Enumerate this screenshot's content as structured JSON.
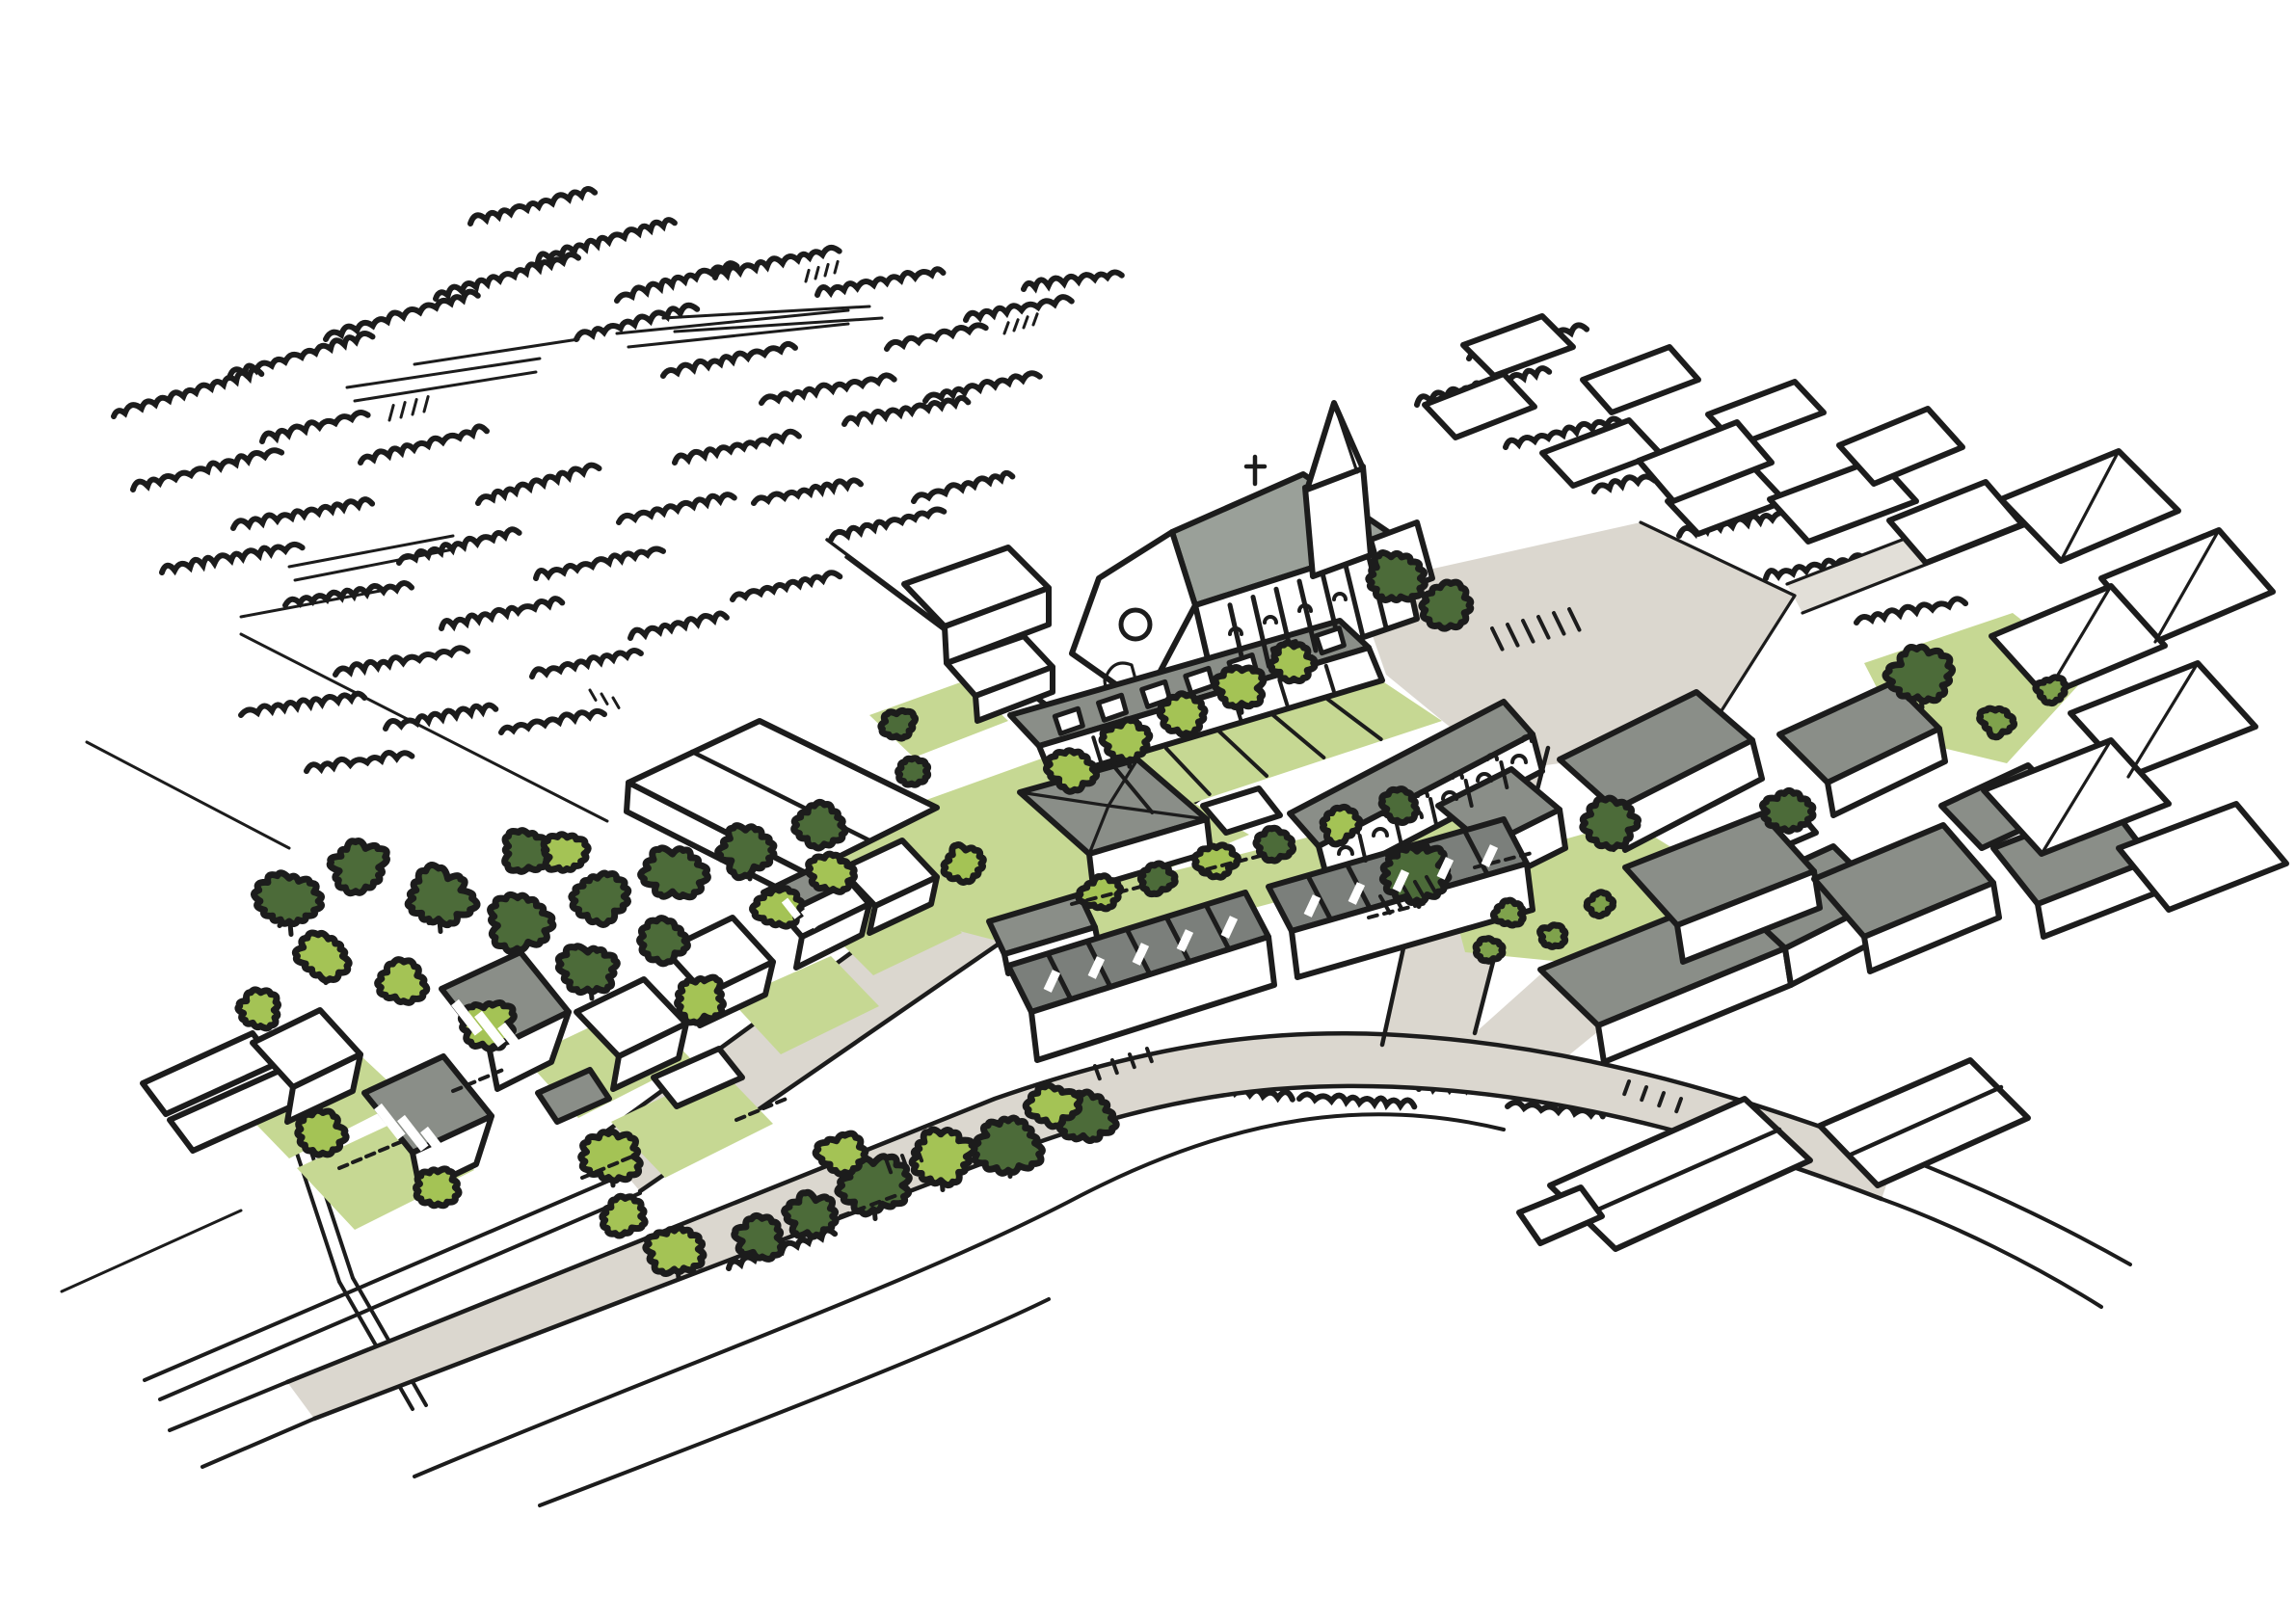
{
  "scene": {
    "kind": "hand-drawn aerial axonometric masterplan sketch",
    "subject": "village centre with church, new terraced housing, courtyard cluster, garden plots, orchards and existing village context",
    "background": "white"
  },
  "palette": {
    "ink": "#1c1c1c",
    "roof": "#8a8e88",
    "roofd": "#7b7f7b",
    "roofl": "#9aa099",
    "road": "#dbd7cf",
    "roadl": "#e2dfd8",
    "lawn": "#c6d893",
    "tree_lime": "#a4c355",
    "tree_dark": "#4c6b39",
    "bush_olive": "#7fa24c",
    "white": "#ffffff"
  },
  "gen": {
    "trees": [
      [
        300,
        935,
        30,
        "d",
        1
      ],
      [
        372,
        900,
        26,
        "d",
        0
      ],
      [
        455,
        932,
        30,
        "d",
        1
      ],
      [
        540,
        956,
        28,
        "d",
        0
      ],
      [
        622,
        930,
        26,
        "d",
        1
      ],
      [
        700,
        906,
        28,
        "d",
        0
      ],
      [
        776,
        882,
        26,
        "d",
        1
      ],
      [
        850,
        856,
        24,
        "d",
        0
      ],
      [
        546,
        882,
        22,
        "d",
        0
      ],
      [
        612,
        1006,
        26,
        "d",
        1
      ],
      [
        690,
        976,
        22,
        "d",
        0
      ],
      [
        336,
        992,
        24,
        "l",
        1
      ],
      [
        416,
        1020,
        22,
        "l",
        0
      ],
      [
        506,
        1062,
        24,
        "l",
        1
      ],
      [
        586,
        886,
        20,
        "l",
        0
      ],
      [
        726,
        1036,
        24,
        "l",
        1
      ],
      [
        806,
        942,
        22,
        "l",
        0
      ],
      [
        268,
        1048,
        20,
        "l",
        0
      ],
      [
        862,
        906,
        20,
        "l",
        0
      ],
      [
        906,
        1230,
        30,
        "d",
        1
      ],
      [
        1046,
        1186,
        30,
        "d",
        1
      ],
      [
        1126,
        1160,
        26,
        "d",
        0
      ],
      [
        842,
        1262,
        24,
        "d",
        0
      ],
      [
        788,
        1284,
        22,
        "d",
        0
      ],
      [
        976,
        1200,
        30,
        "l",
        1
      ],
      [
        1092,
        1146,
        22,
        "l",
        0
      ],
      [
        702,
        1296,
        26,
        "l",
        1
      ],
      [
        646,
        1262,
        20,
        "l",
        0
      ],
      [
        874,
        1198,
        22,
        "l",
        0
      ],
      [
        634,
        1200,
        26,
        "l",
        1
      ],
      [
        452,
        1232,
        20,
        "l",
        0
      ],
      [
        332,
        1176,
        22,
        "l",
        0
      ],
      [
        1112,
        798,
        22,
        "l",
        0
      ],
      [
        1170,
        770,
        22,
        "l",
        1
      ],
      [
        1228,
        742,
        22,
        "l",
        0
      ],
      [
        1286,
        714,
        22,
        "l",
        1
      ],
      [
        1340,
        688,
        20,
        "l",
        0
      ],
      [
        1446,
        600,
        26,
        "d",
        0
      ],
      [
        1502,
        628,
        22,
        "d",
        0
      ],
      [
        1470,
        906,
        30,
        "d",
        1
      ],
      [
        1672,
        854,
        24,
        "d",
        1
      ],
      [
        1142,
        928,
        18,
        "l",
        0
      ],
      [
        1262,
        894,
        18,
        "l",
        0
      ],
      [
        1390,
        856,
        18,
        "l",
        0
      ],
      [
        1200,
        912,
        16,
        "d",
        0
      ],
      [
        1322,
        876,
        16,
        "d",
        0
      ],
      [
        1452,
        836,
        16,
        "d",
        0
      ],
      [
        1566,
        948,
        14,
        "o",
        0
      ],
      [
        1610,
        972,
        12,
        "o",
        0
      ],
      [
        1546,
        986,
        12,
        "o",
        0
      ],
      [
        1660,
        938,
        12,
        "o",
        0
      ],
      [
        1992,
        702,
        28,
        "d",
        1
      ],
      [
        2072,
        748,
        16,
        "o",
        0
      ],
      [
        2128,
        716,
        14,
        "o",
        0
      ],
      [
        1856,
        842,
        24,
        "d",
        0
      ],
      [
        1000,
        896,
        20,
        "l",
        0
      ],
      [
        948,
        800,
        14,
        "d",
        0
      ],
      [
        932,
        752,
        16,
        "d",
        0
      ]
    ],
    "hedges": [
      [
        118,
        432,
        150,
        -16
      ],
      [
        238,
        392,
        140,
        -16
      ],
      [
        338,
        352,
        150,
        -16
      ],
      [
        452,
        310,
        150,
        -16
      ],
      [
        558,
        272,
        140,
        -16
      ],
      [
        488,
        232,
        120,
        -14
      ],
      [
        640,
        312,
        120,
        -16
      ],
      [
        742,
        288,
        130,
        -12
      ],
      [
        848,
        306,
        130,
        -10
      ],
      [
        598,
        352,
        120,
        -14
      ],
      [
        688,
        390,
        130,
        -12
      ],
      [
        790,
        418,
        130,
        -10
      ],
      [
        876,
        440,
        120,
        -10
      ],
      [
        960,
        416,
        110,
        -12
      ],
      [
        138,
        508,
        150,
        -14
      ],
      [
        242,
        548,
        140,
        -10
      ],
      [
        168,
        594,
        140,
        -10
      ],
      [
        296,
        628,
        130,
        -8
      ],
      [
        414,
        584,
        120,
        -14
      ],
      [
        496,
        522,
        130,
        -16
      ],
      [
        374,
        480,
        130,
        -14
      ],
      [
        272,
        458,
        110,
        -14
      ],
      [
        700,
        480,
        130,
        -12
      ],
      [
        782,
        522,
        110,
        -10
      ],
      [
        642,
        542,
        120,
        -12
      ],
      [
        556,
        600,
        130,
        -12
      ],
      [
        458,
        652,
        120,
        -12
      ],
      [
        348,
        700,
        130,
        -10
      ],
      [
        250,
        742,
        120,
        -8
      ],
      [
        552,
        702,
        110,
        -12
      ],
      [
        654,
        662,
        100,
        -12
      ],
      [
        760,
        622,
        110,
        -12
      ],
      [
        862,
        560,
        120,
        -14
      ],
      [
        948,
        520,
        100,
        -14
      ],
      [
        400,
        756,
        110,
        -10
      ],
      [
        318,
        800,
        100,
        -8
      ],
      [
        520,
        760,
        100,
        -10
      ],
      [
        1002,
        332,
        110,
        -10
      ],
      [
        920,
        362,
        100,
        -12
      ],
      [
        1062,
        300,
        90,
        -8
      ],
      [
        1470,
        420,
        140,
        -14
      ],
      [
        1562,
        464,
        120,
        -12
      ],
      [
        1654,
        510,
        120,
        -12
      ],
      [
        1524,
        372,
        110,
        -14
      ],
      [
        1742,
        556,
        110,
        -10
      ],
      [
        1832,
        600,
        110,
        -10
      ],
      [
        1926,
        646,
        100,
        -10
      ],
      [
        1220,
        1128,
        120,
        6
      ],
      [
        1348,
        1140,
        110,
        4
      ],
      [
        1472,
        1130,
        100,
        2
      ],
      [
        1564,
        1148,
        90,
        6
      ],
      [
        756,
        1316,
        110,
        -18
      ],
      [
        614,
        1352,
        100,
        -18
      ]
    ],
    "lines": [
      [
        360,
        402,
        560,
        372,
        3
      ],
      [
        368,
        416,
        556,
        386,
        3
      ],
      [
        430,
        378,
        600,
        352,
        3
      ],
      [
        300,
        588,
        470,
        556,
        3
      ],
      [
        306,
        602,
        470,
        570,
        3
      ],
      [
        250,
        640,
        400,
        612,
        3
      ],
      [
        640,
        346,
        880,
        322,
        3
      ],
      [
        652,
        360,
        880,
        336,
        3
      ],
      [
        688,
        330,
        902,
        318,
        3
      ],
      [
        700,
        344,
        915,
        330,
        3
      ],
      [
        250,
        658,
        630,
        852,
        3
      ],
      [
        90,
        770,
        300,
        880,
        3
      ],
      [
        150,
        1432,
        648,
        1218,
        4
      ],
      [
        166,
        1452,
        664,
        1238,
        4
      ],
      [
        64,
        1340,
        250,
        1256,
        3
      ],
      [
        1128,
        762,
        858,
        560,
        3.5
      ],
      [
        1146,
        778,
        878,
        578,
        3.5
      ],
      [
        292,
        1148,
        352,
        1330,
        4
      ],
      [
        306,
        1144,
        366,
        1326,
        4
      ],
      [
        352,
        1330,
        428,
        1462,
        4
      ],
      [
        366,
        1326,
        442,
        1458,
        4
      ]
    ],
    "curves": [
      [
        "M430,1532 C700,1418 952,1330 1122,1240 C1282,1158 1420,1138 1560,1172",
        4
      ],
      [
        "M560,1562 C800,1470 986,1398 1088,1348",
        4
      ],
      [
        "M1968,1198 C2056,1232 2136,1270 2210,1312",
        4
      ],
      [
        "M1952,1244 C2030,1272 2110,1312 2180,1356",
        4
      ],
      [
        "M298,1434 L176,1484",
        4
      ],
      [
        "M326,1472 L210,1522",
        4
      ]
    ],
    "ticks": [
      [
        1548,
        652,
        6,
        16,
        -4,
        24,
        64,
        4,
        "ink"
      ],
      [
        1432,
        930,
        5,
        12,
        -5,
        20,
        60,
        4,
        "ink"
      ],
      [
        1136,
        1106,
        4,
        18,
        -6,
        14,
        70,
        4,
        "ink"
      ],
      [
        1690,
        1122,
        4,
        18,
        6,
        14,
        110,
        4,
        "ink"
      ],
      [
        920,
        1205,
        3,
        16,
        -6,
        12,
        70,
        4,
        "ink"
      ],
      [
        352,
        1212,
        5,
        14,
        -6,
        9,
        -22,
        4,
        "ink"
      ],
      [
        470,
        1132,
        4,
        14,
        -6,
        9,
        -22,
        4,
        "ink"
      ],
      [
        604,
        1222,
        4,
        14,
        -6,
        9,
        -22,
        4,
        "ink"
      ],
      [
        764,
        1162,
        4,
        14,
        -6,
        9,
        -22,
        4,
        "ink"
      ],
      [
        1112,
        938,
        5,
        16,
        -4,
        9,
        -15,
        4,
        "ink"
      ],
      [
        1252,
        902,
        4,
        16,
        -4,
        9,
        -15,
        4,
        "ink"
      ],
      [
        1420,
        952,
        4,
        16,
        -4,
        9,
        -15,
        4,
        "ink"
      ],
      [
        872,
        1262,
        4,
        16,
        -6,
        9,
        -20,
        4,
        "ink"
      ],
      [
        1530,
        900,
        4,
        16,
        -4,
        9,
        -15,
        4,
        "ink"
      ],
      [
        404,
        436,
        4,
        12,
        -3,
        16,
        -75,
        3,
        "ink"
      ],
      [
        836,
        292,
        4,
        10,
        -3,
        12,
        -75,
        3,
        "ink"
      ],
      [
        1042,
        346,
        4,
        10,
        -3,
        12,
        -70,
        3,
        "ink"
      ],
      [
        612,
        716,
        3,
        12,
        4,
        12,
        60,
        3,
        "ink"
      ],
      [
        472,
        1040,
        3,
        24,
        12,
        40,
        52,
        10,
        "white"
      ],
      [
        392,
        1148,
        3,
        24,
        12,
        40,
        52,
        10,
        "white"
      ],
      [
        814,
        934,
        2,
        20,
        10,
        22,
        52,
        8,
        "white"
      ],
      [
        1096,
        1008,
        5,
        46,
        -14,
        22,
        115,
        9,
        "white"
      ],
      [
        1366,
        930,
        5,
        46,
        -13,
        22,
        115,
        9,
        "white"
      ]
    ],
    "ribs": [
      [
        1252,
        636,
        1444,
        570,
        1268,
        708,
        1462,
        642,
        7,
        5
      ],
      [
        1086,
        780,
        1424,
        676,
        1094,
        806,
        1432,
        702,
        6,
        4
      ],
      [
        1046,
        1002,
        1292,
        926,
        1070,
        1050,
        1316,
        972,
        5,
        5
      ],
      [
        1316,
        920,
        1560,
        850,
        1340,
        966,
        1584,
        896,
        5,
        5
      ],
      [
        1374,
        886,
        1594,
        772,
        1380,
        912,
        1600,
        798,
        5,
        4
      ],
      [
        1100,
        812,
        1430,
        706,
        1136,
        862,
        1492,
        748,
        5,
        4
      ]
    ],
    "dormers": [
      [
        1082,
        747,
        1390,
        652,
        7
      ]
    ],
    "arches": [
      [
        1396,
        886,
        6,
        36,
        -19,
        7
      ],
      [
        1404,
        864,
        6,
        36,
        -19,
        5
      ],
      [
        1282,
        658,
        4,
        36,
        -12,
        6
      ]
    ]
  }
}
